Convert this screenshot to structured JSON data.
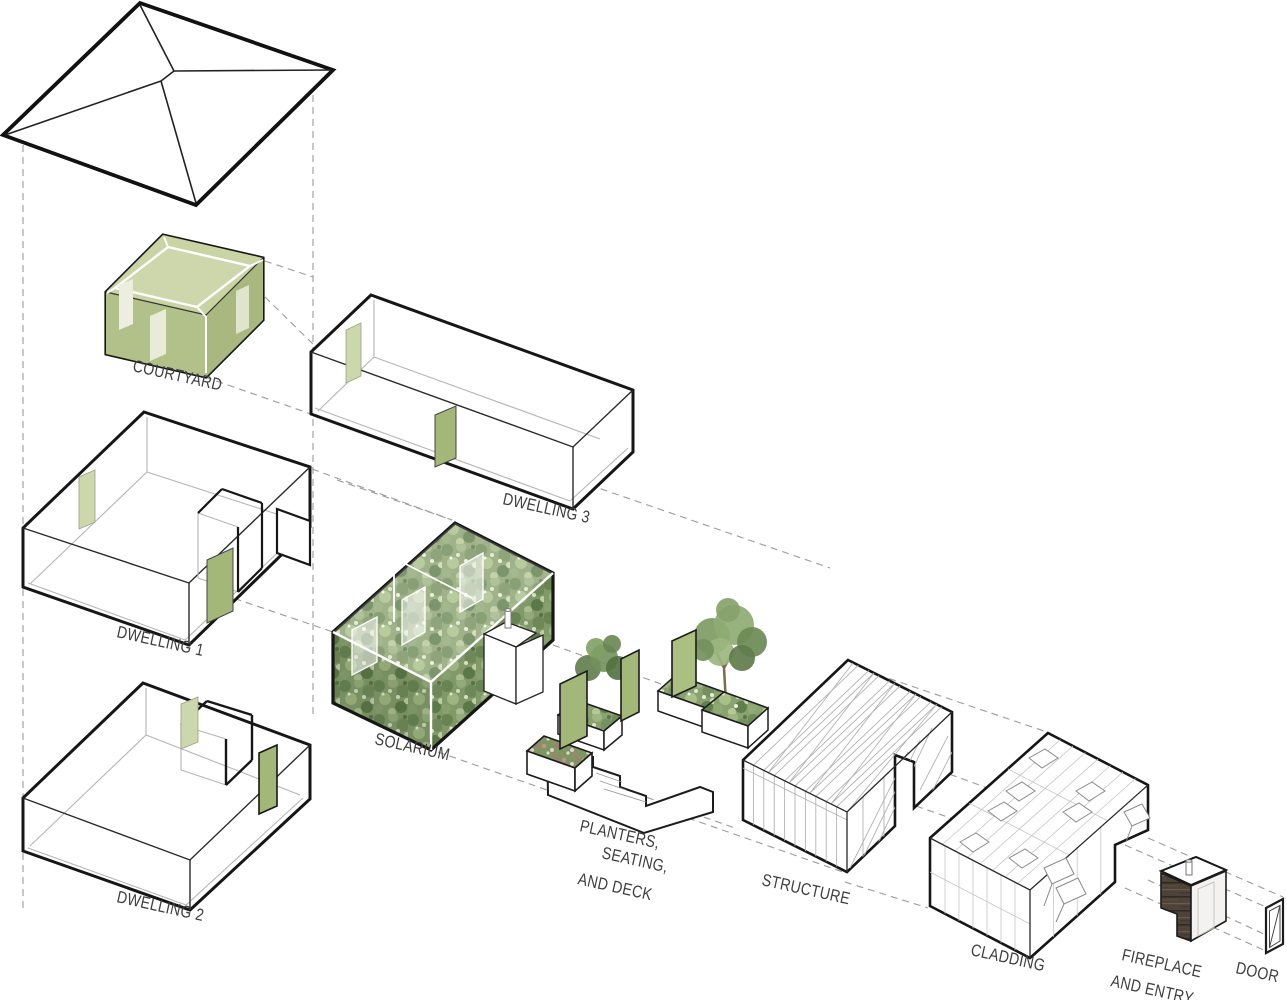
{
  "figure": {
    "kind": "Exploded axonometric architectural diagram",
    "background": "#ffffff"
  },
  "labels": {
    "courtyard": "COURTYARD",
    "dwelling3": "DWELLING 3",
    "dwelling1": "DWELLING 1",
    "solarium": "SOLARIUM",
    "dwelling2": "DWELLING 2",
    "planters1": "PLANTERS,",
    "planters2": "SEATING,",
    "planters3": "AND DECK",
    "structure": "STRUCTURE",
    "cladding": "CLADDING",
    "fireplace1": "FIREPLACE",
    "fireplace2": "AND ENTRY",
    "door": "DOOR"
  },
  "colors": {
    "outline": "#161616",
    "guide_gray": "#9b9b9b",
    "label_gray": "#3e3e3e",
    "panel_green": "#a3b878",
    "pale_green": "#ccd7ab",
    "courtyard_green": "#b6c48e",
    "wood_brown": "#4a4036"
  }
}
